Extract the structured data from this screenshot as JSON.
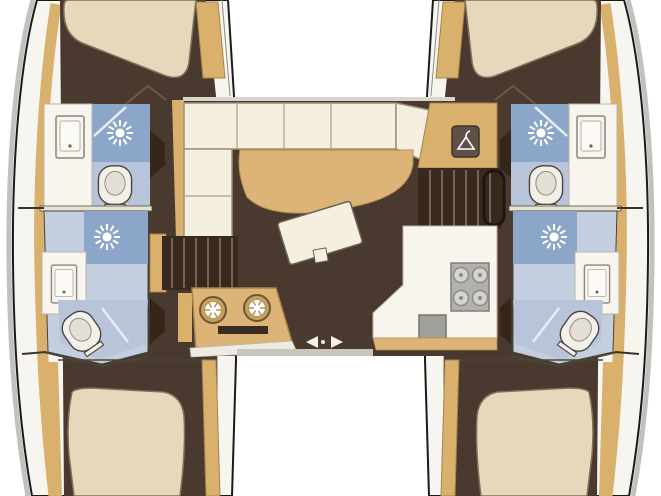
{
  "plan": {
    "type": "catamaran-interior-floorplan",
    "hulls": {
      "port": {
        "areas": [
          "forward-cabin-berth",
          "forward-head",
          "aft-head",
          "aft-cabin-berth"
        ],
        "fixtures": [
          "sink",
          "shower",
          "toilet",
          "shower",
          "sink",
          "toilet"
        ]
      },
      "starboard": {
        "areas": [
          "forward-cabin-berth",
          "forward-head",
          "aft-head",
          "aft-cabin-berth"
        ],
        "fixtures": [
          "sink",
          "shower",
          "toilet",
          "shower",
          "sink",
          "toilet"
        ]
      }
    },
    "salon": {
      "features": [
        "l-shaped-sofa",
        "dinette-table",
        "cocktail-table",
        "nav-cabinet",
        "hanging-locker",
        "companionway-stairs-port",
        "companionway-stairs-starboard",
        "galley-round-sinks",
        "oven",
        "galley-stove-4-burner",
        "galley-sink",
        "sliding-door"
      ]
    },
    "icons": [
      "shower-head-icon",
      "toilet-icon",
      "sink-icon",
      "hanger-icon",
      "stove-burner-icon",
      "round-sink-icon",
      "sliding-door-arrows-icon"
    ]
  },
  "colors": {
    "background": "#ffffff",
    "hull_outline": "#1b1a17",
    "hull_shadow": "#c2c1bf",
    "deck": "#f6f5f0",
    "wall_tan": "#d9b06c",
    "wall_tan_dark": "#a8834b",
    "floor_brown": "#4a392e",
    "stairs_dark": "#38291f",
    "stair_tread": "#7a6352",
    "bed_beige": "#e6d8bb",
    "bed_outline": "#7d6f58",
    "sofa_cream": "#f4efdf",
    "sofa_outline": "#9b9079",
    "table_tan": "#dcb477",
    "bath_blue": "#c3cede",
    "shower_blue": "#8ca6c9",
    "bath_blue_mid": "#b7c4d9",
    "fixture_white": "#f2f0e8",
    "counter_white": "#f7f5ee",
    "counter_edge": "#b9b5a9",
    "appliance_gray": "#b3b1ac",
    "appliance_dark": "#76746f",
    "toilet_outline": "#4a443c",
    "icon_white": "#ffffff",
    "hanger_box": "#5f5048",
    "door_wedge": "#352619",
    "door_track_gray": "#c9c6c0",
    "oven_slot": "#3a2b20"
  }
}
